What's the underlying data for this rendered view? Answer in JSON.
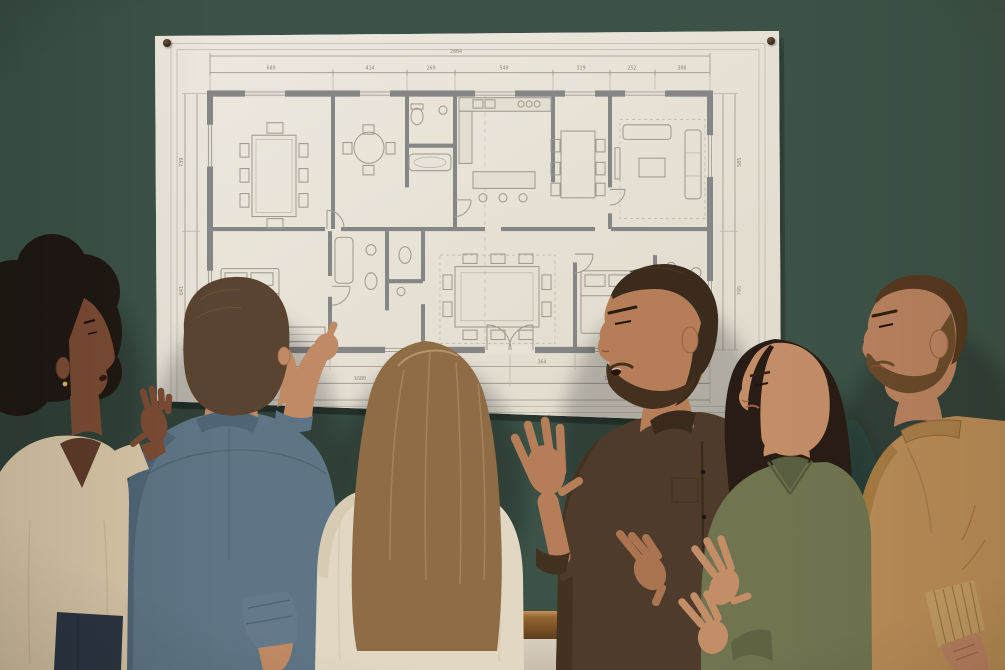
{
  "scene": {
    "type": "photograph",
    "description": "Six colleagues stand in front of a dark green chalkboard wall discussing a large architectural floor plan pinned to it",
    "wall": "dark green chalkboard with wooden chalk tray and cream wainscot below"
  },
  "poster": {
    "kind": "architectural floor plan blueprint",
    "paper_color": "#e9e4da",
    "pins": [
      {
        "name": "pushpin-top-left"
      },
      {
        "name": "pushpin-top-right"
      }
    ],
    "blueprint": {
      "top_total": "2804",
      "top_dims": [
        "689",
        "414",
        "269",
        "549",
        "319",
        "252",
        "308"
      ],
      "bottom_dims": [
        "672",
        "1008",
        "364",
        "756"
      ],
      "bottom_spans": [
        "1680",
        "1120"
      ],
      "bottom_total": "2804",
      "left_dims": [
        "739",
        "641"
      ],
      "right_dims": [
        "585",
        "795"
      ],
      "rooms": [
        "dining room",
        "breakfast nook",
        "bathroom",
        "kitchen",
        "dining area",
        "living room",
        "bedroom",
        "bathroom",
        "wc",
        "great room",
        "bedroom",
        "bathroom"
      ]
    }
  },
  "people": [
    {
      "id": "woman-afro",
      "position": "far left",
      "facing": "right profile",
      "hair": "black afro",
      "top": "beige v-neck sweater",
      "bottom": "dark jeans",
      "action": "right hand raised open beside the blueprint",
      "accessory": "gold earring"
    },
    {
      "id": "man-denim",
      "position": "second from left",
      "facing": "back to camera",
      "hair": "short brown",
      "top": "denim shirt with rolled cuffs",
      "action": "pointing at the floor plan with right index finger"
    },
    {
      "id": "woman-back",
      "position": "center",
      "facing": "back to camera",
      "hair": "long light-brown",
      "top": "cream sweater",
      "action": "looking at the plan"
    },
    {
      "id": "man-brown-shirt",
      "position": "center right",
      "facing": "left three-quarter profile",
      "hair": "dark brown, full beard",
      "top": "brown button-up shirt",
      "action": "speaking, left palm raised, right hand gesturing"
    },
    {
      "id": "woman-olive",
      "position": "second from right",
      "facing": "left profile",
      "hair": "long dark brown",
      "top": "olive green shirt",
      "action": "gesturing with both hands"
    },
    {
      "id": "man-tan",
      "position": "far right",
      "facing": "left profile",
      "hair": "short brown with fade, beard",
      "top": "camel tan crew-neck sweater",
      "action": "listening, arms lowered"
    }
  ],
  "colors": {
    "wall_green": "#3d5247",
    "wall_green_dark": "#2c3f35",
    "ledge_wood": "#94662f",
    "wainscot": "#d8cec0",
    "paper": "#e9e4da",
    "pin": "#382a1d",
    "denim": "#5d7585",
    "beige": "#d8c5a6",
    "cream": "#e2d7c2",
    "brown4": "#4f3b2b",
    "olive": "#70744f",
    "tan": "#bb8d57",
    "skin1": "#7b4b34",
    "skin2": "#c08a64",
    "skin4": "#b67e58",
    "skin5": "#c38d68",
    "skin6": "#bb8360",
    "hair1": "#1f1813",
    "hair2": "#5a4330",
    "hair3": "#8d6c46",
    "hair4": "#3b2b1d",
    "hair5": "#281c14",
    "hair6": "#55391f",
    "beard4": "#43301f",
    "beard6": "#6b4a2c"
  }
}
